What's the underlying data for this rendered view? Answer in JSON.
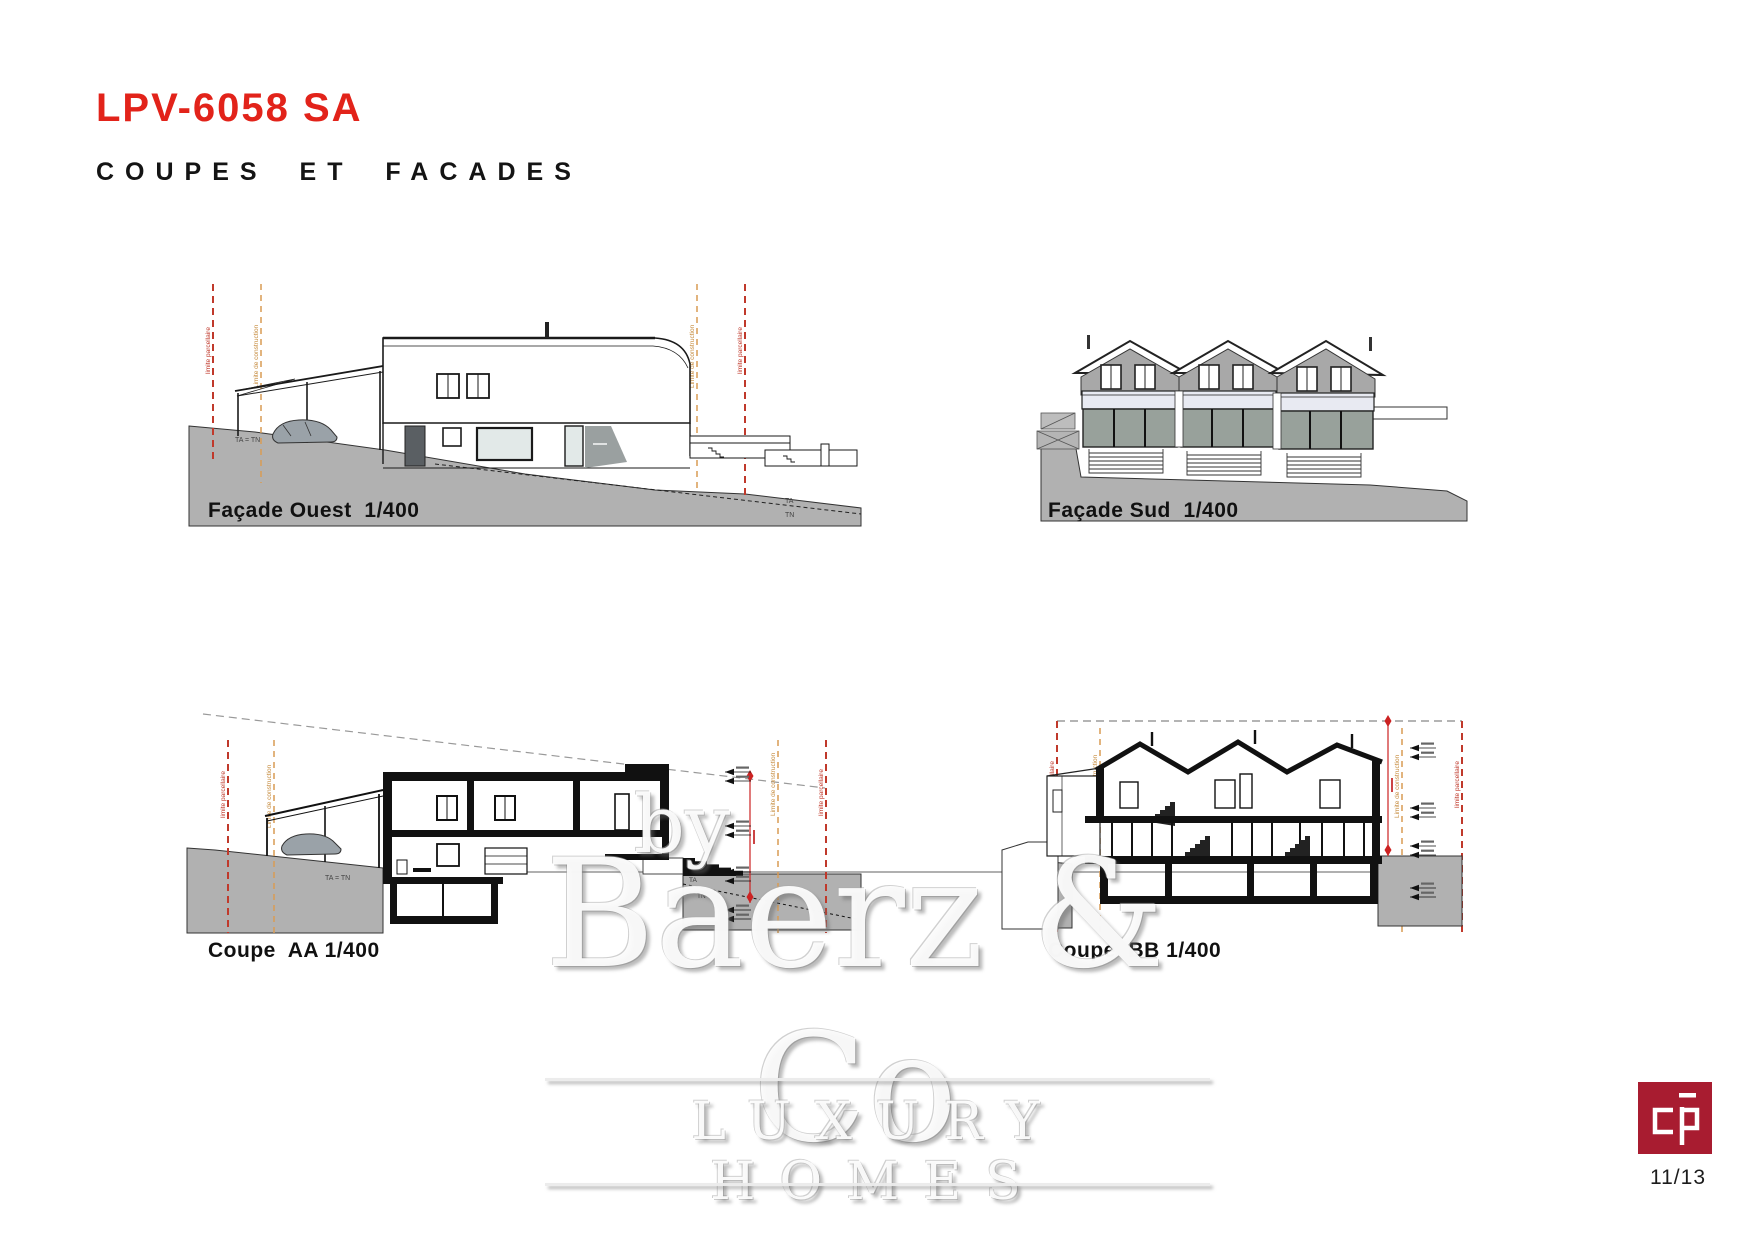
{
  "page": {
    "title": "LPV-6058 SA",
    "subtitle": "COUPES ET FACADES",
    "page_number": "11/13"
  },
  "drawings": [
    {
      "id": "facade-ouest",
      "label": "Façade Ouest  1/400"
    },
    {
      "id": "facade-sud",
      "label": "Façade Sud  1/400"
    },
    {
      "id": "coupe-aa",
      "label": "Coupe  AA 1/400"
    },
    {
      "id": "coupe-bb",
      "label": "Coupe  BB 1/400"
    }
  ],
  "annotations": {
    "ta_eq_tn": "TA = TN",
    "ta": "TA",
    "tn": "TN",
    "limite_parcellaire": "limite parcellaire",
    "limite_construction": "Limite de construction"
  },
  "watermark": {
    "by": "by",
    "name": "Baerz & Co",
    "tagline": "LUXURY HOMES"
  },
  "logo": {
    "glyph": "cp",
    "color": "#a81c30"
  },
  "colors": {
    "accent_red": "#e2231a",
    "logo_red": "#a81c30",
    "terrain_grey": "#b1b1b1",
    "limit_red": "#c0392b",
    "limit_orange": "#d99c54",
    "ink": "#1a1a1a"
  }
}
